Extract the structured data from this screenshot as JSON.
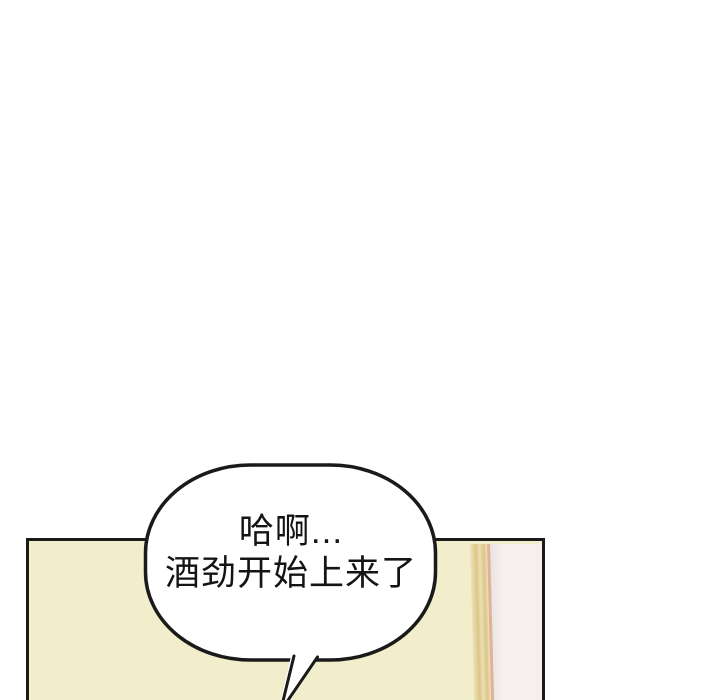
{
  "scene": {
    "type": "webtoon-panel",
    "description": "comic strip frame with cream room wall, wooden door trim and a speech bubble"
  },
  "bubble": {
    "line1": "哈啊...",
    "line2": "酒劲开始上来了"
  },
  "theme": {
    "line_color": "#1a1a1a",
    "bubble_fill": "#ffffff",
    "panel_fill": "#f2edca",
    "doorframe_light": "#eee2bd",
    "doorframe_mid": "#dcc685",
    "doorframe_edge": "#e0b29c",
    "wall_fill": "#f5eff0",
    "wall_shadow": "#e9e2df",
    "text_color": "#141414",
    "page_bg": "#ffffff"
  }
}
